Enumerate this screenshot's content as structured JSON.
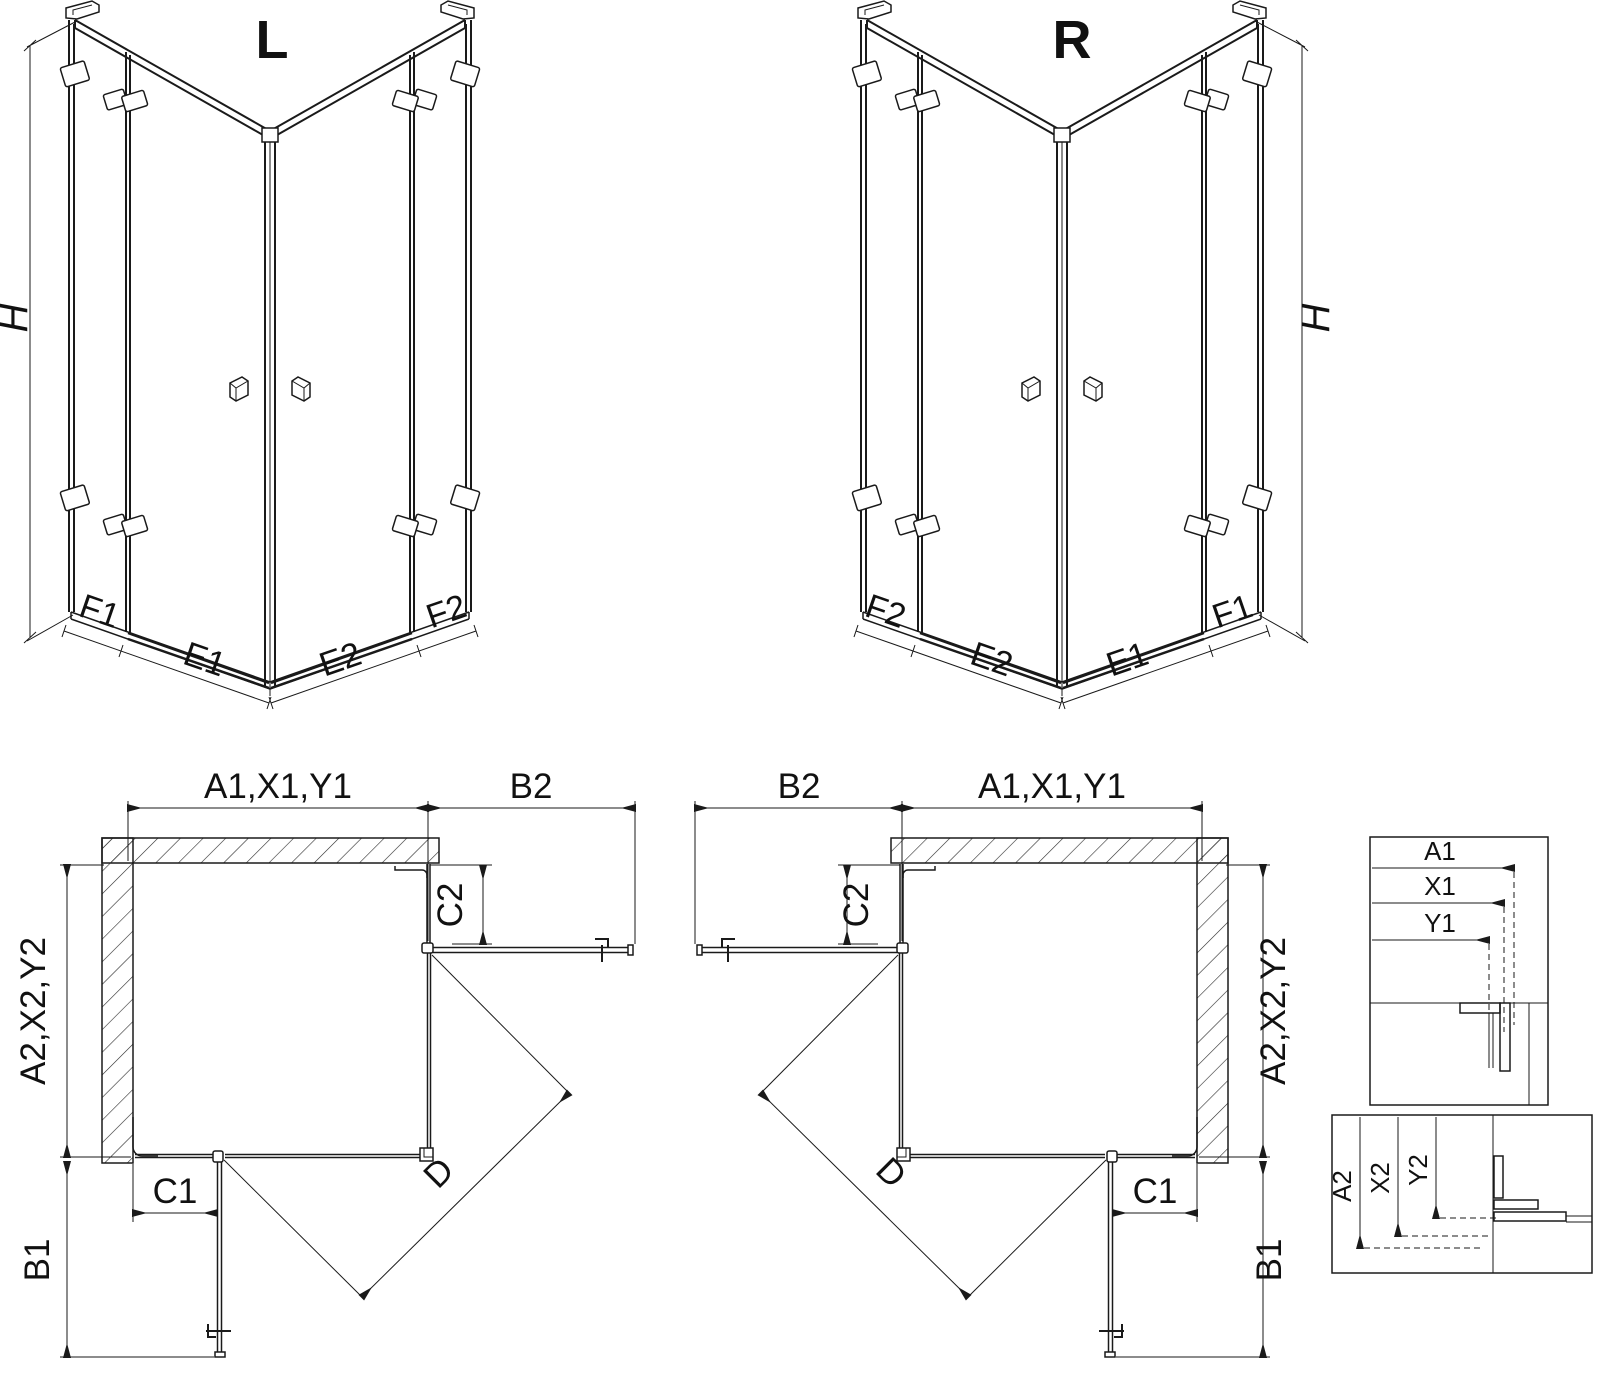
{
  "drawing": {
    "iso_left": {
      "title": "L",
      "h": "H",
      "f1": "F1",
      "e1": "E1",
      "e2": "E2",
      "f2": "F2"
    },
    "iso_right": {
      "title": "R",
      "h": "H",
      "f1": "F1",
      "e1": "E1",
      "e2": "E2",
      "f2": "F2"
    },
    "plan_left": {
      "a1": "A1,X1,Y1",
      "b2": "B2",
      "c2": "C2",
      "a2": "A2,X2,Y2",
      "b1": "B1",
      "c1": "C1",
      "d": "D"
    },
    "plan_right": {
      "a1": "A1,X1,Y1",
      "b2": "B2",
      "c2": "C2",
      "a2": "A2,X2,Y2",
      "b1": "B1",
      "c1": "C1",
      "d": "D"
    },
    "detail_top": {
      "a1": "A1",
      "x1": "X1",
      "y1": "Y1"
    },
    "detail_bottom": {
      "a2": "A2",
      "x2": "X2",
      "y2": "Y2"
    },
    "colors": {
      "line": "#1a1a1a",
      "background": "#ffffff"
    }
  }
}
